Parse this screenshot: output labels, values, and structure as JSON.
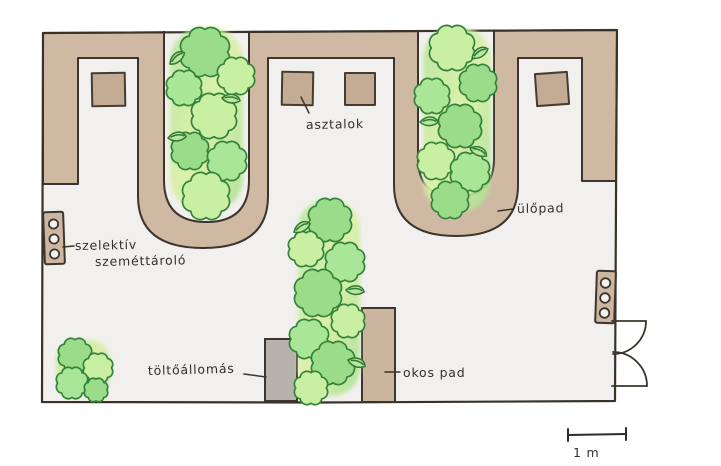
{
  "plan": {
    "labels": {
      "tables": "asztalok",
      "bench": "ülőpad",
      "recycling_line1": "szelektív",
      "recycling_line2": "szeméttároló",
      "charging_station": "töltőállomás",
      "smart_bench": "okos pad"
    },
    "scale_bar": {
      "label": "1 m"
    },
    "colors": {
      "bench_band_tan": "#cfb9a3",
      "table_tan": "#c3ab94",
      "floor": "#f2f0ee",
      "hedge_green_light": "#c9efa2",
      "hedge_green": "#9bdc8a",
      "hedge_outline_green": "#35823a",
      "charging_station_gray": "#b8b2ac",
      "ink": "#3b352d",
      "page": "#ffffff"
    },
    "counts": {
      "tables": 4,
      "hedges": 3,
      "corner_bushes": 1,
      "recycling_bins": 2,
      "double_doors": 1
    }
  }
}
